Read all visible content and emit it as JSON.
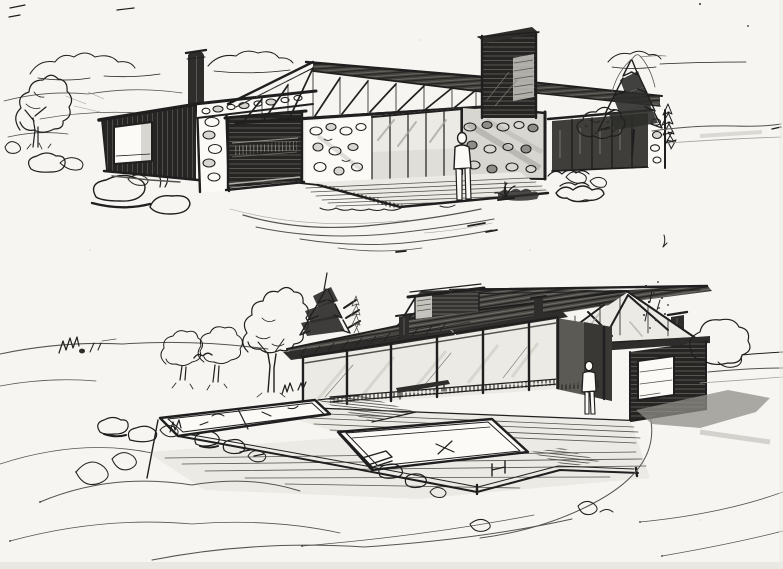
{
  "meta": {
    "title": "Hand-drawn architectural concept sketches - two house studies",
    "medium_note": "black ink and grey marker on white paper",
    "figure_count": 2
  },
  "palette": {
    "paper": "#f6f5f1",
    "paper_bright": "#fbfaf7",
    "ink": "#1f1f1f",
    "ink_soft": "#55534f",
    "pencil": "#a2a09a",
    "wash_dark": "#2e2d2b",
    "wash_mid": "#8f8d88",
    "wash_light": "#d8d6d0",
    "glass_dark": "#3f3e3a",
    "glass_light": "#eceae4"
  },
  "scene": {
    "sketches": [
      {
        "id": "upper-study",
        "label": "Upper sketch: low single-storey house with fieldstone walls, clerestory truss band under a long low-pitched roof, tall timber-clad fireplace tower, dark timber carport wing with picture window, timber deck, standing human figure, deciduous tree and boulders at left, pine trees and shrubs at right, loose clouds and hill lines behind",
        "elements": [
          "clouds",
          "hill-lines",
          "deciduous-tree",
          "boulders",
          "chimney",
          "carport-wing",
          "picture-window",
          "stone-pier",
          "carport-opening",
          "stone-lintel",
          "roof",
          "clerestory-trusses",
          "fireplace-tower",
          "stone-wall",
          "glazed-doors",
          "shaded-stone-wall",
          "person",
          "timber-deck",
          "glazed-wing",
          "stone-end-pier",
          "pine-trees",
          "shrubs",
          "driveway-sweeps",
          "horizon-lines"
        ]
      },
      {
        "id": "lower-study",
        "label": "Lower sketch: hillside house with long mono-pitch roof, rooftop clerestory monitor, three chimneys, braced glazed gable, glazed porch with posts and railing, standing figure at the entry, dark timber wing with window opening, timber pool terrace with two pools and steps, boulders, grass tufts and meadow contour lines in the foreground, trees behind",
        "elements": [
          "hill-lines",
          "shrub-marks",
          "round-trees",
          "tall-deciduous-tree",
          "pine-tree",
          "roof",
          "clerestory-monitor",
          "chimneys",
          "braced-gable",
          "porch-posts",
          "glazed-wall",
          "railing",
          "bench",
          "entry-porch",
          "person",
          "timber-wing",
          "window-opening",
          "pool-terrace",
          "upper-pool",
          "main-pool",
          "steps",
          "deck-boards",
          "boulders",
          "grass-tufts",
          "meadow-contours",
          "shadow-wash",
          "loose-tree",
          "horizon-lines"
        ]
      }
    ]
  }
}
